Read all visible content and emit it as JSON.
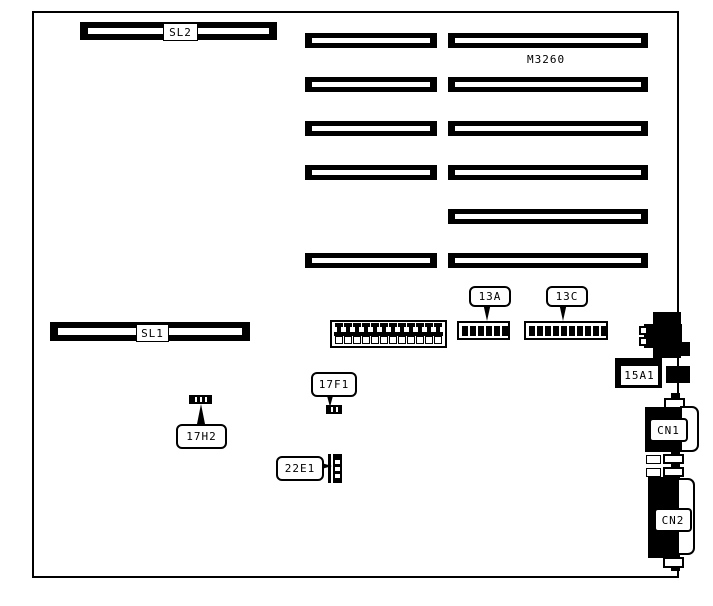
{
  "board": {
    "colors": {
      "ink": "#000000",
      "background": "#ffffff"
    },
    "chip_marking": "M3260",
    "slot_sl2": {
      "label": "SL2"
    },
    "slot_sl1": {
      "label": "SL1"
    },
    "expansion_slots": {
      "left_column_count": 5,
      "right_column_count": 6
    },
    "pin_header": {
      "top_pin_count": 12,
      "bottom_pin_count": 12
    },
    "dip_switch_13a": {
      "label": "13A",
      "switch_count": 6
    },
    "dip_switch_13c": {
      "label": "13C",
      "switch_count": 10
    },
    "connector_15a1": {
      "label": "15A1"
    },
    "connector_cn1": {
      "label": "CN1"
    },
    "connector_cn2": {
      "label": "CN2"
    },
    "jumper_17f1": {
      "label": "17F1",
      "tick_count": 2
    },
    "jumper_17h2": {
      "label": "17H2",
      "tick_count": 3
    },
    "jumper_22e1": {
      "label": "22E1",
      "tick_count": 3
    }
  }
}
